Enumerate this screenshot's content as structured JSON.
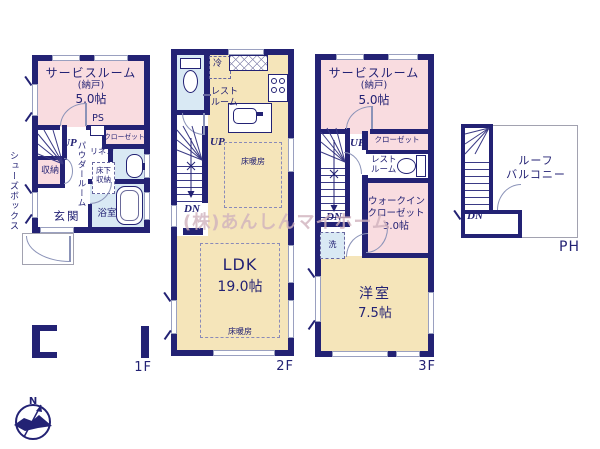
{
  "colors": {
    "wall": "#232274",
    "pink": "#f9dce0",
    "cream": "#f5e5ba",
    "blue": "#d9e9f4",
    "gray": "#a2a2b0"
  },
  "watermark": "(株)あんしんマイホーム",
  "compass": {
    "north": "N"
  },
  "f1": {
    "label": "1F",
    "service_room": "サービスルーム",
    "service_room_sub": "(納戸)",
    "service_room_size": "5.0帖",
    "ps": "PS",
    "closet": "クローゼット",
    "up": "UP",
    "powder_room": "パウダールーム",
    "linen": "リネン",
    "underfloor_storage": "床下収納",
    "storage": "収納",
    "shoes_box": "シューズボックス",
    "entrance": "玄関",
    "bathroom": "浴室"
  },
  "f2": {
    "label": "2F",
    "rest_room": "レストルーム",
    "fridge": "冷",
    "up": "UP",
    "dn": "DN",
    "floor_heating": "床暖房",
    "ldk": "LDK",
    "ldk_size": "19.0帖"
  },
  "f3": {
    "label": "3F",
    "service_room": "サービスルーム",
    "service_room_sub": "(納戸)",
    "service_room_size": "5.0帖",
    "closet": "クローゼット",
    "rest_room": "レストルーム",
    "up": "UP",
    "dn": "DN",
    "wic_line1": "ウォークイン",
    "wic_line2": "クローゼット",
    "wic_size": "3.0帖",
    "laundry": "洗",
    "western_room": "洋室",
    "western_room_size": "7.5帖"
  },
  "ph": {
    "label": "PH",
    "roof_balcony_line1": "ルーフ",
    "roof_balcony_line2": "バルコニー",
    "dn": "DN"
  }
}
